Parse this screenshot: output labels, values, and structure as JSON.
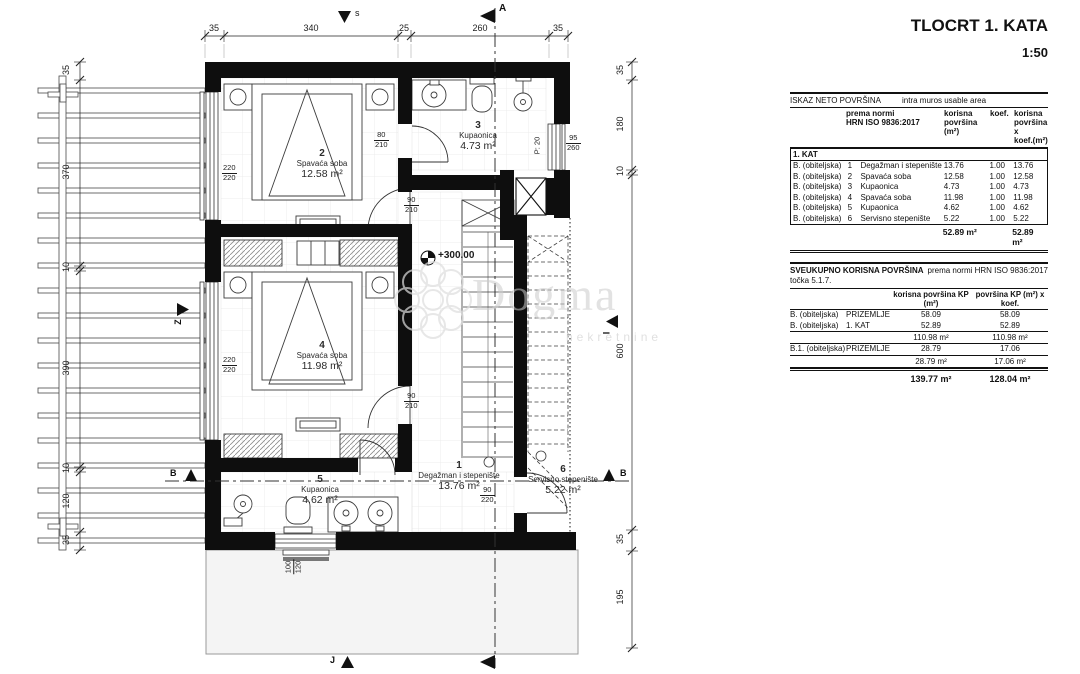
{
  "title": {
    "line1": "TLOCRT 1. KATA",
    "line2": "1:50"
  },
  "watermark": {
    "name": "Dogma",
    "subtitle": "nekretnine"
  },
  "compass": {
    "north": "s",
    "west": "Z",
    "east": "I",
    "south": "J"
  },
  "sections": {
    "a_top": "A",
    "b_left": "B",
    "b_right": "B"
  },
  "level": "+300.00",
  "rooms": {
    "r1": {
      "num": "1",
      "name": "Degažman i stepenište",
      "area": "13.76 m²"
    },
    "r2": {
      "num": "2",
      "name": "Spavaća soba",
      "area": "12.58 m²"
    },
    "r3": {
      "num": "3",
      "name": "Kupaonica",
      "area": "4.73 m²"
    },
    "r4": {
      "num": "4",
      "name": "Spavaća soba",
      "area": "11.98 m²"
    },
    "r5": {
      "num": "5",
      "name": "Kupaonica",
      "area": "4.62 m²"
    },
    "r6": {
      "num": "6",
      "name": "Servisno stepenište",
      "area": "5.22 m²"
    }
  },
  "openings": {
    "bath3_door": {
      "w": "80",
      "h": "210"
    },
    "bed2_door": {
      "w": "90",
      "h": "210"
    },
    "bed4_door": {
      "w": "90",
      "h": "210"
    },
    "service_door": {
      "w": "90",
      "h": "220"
    },
    "bed2_window": {
      "w": "220",
      "h": "220"
    },
    "bed4_window": {
      "w": "220",
      "h": "220"
    },
    "bath3_window": {
      "w": "95",
      "h": "260",
      "parapet": "P: 20"
    },
    "bath5_window": {
      "w": "100",
      "h": "120"
    }
  },
  "dims": {
    "top": [
      "35",
      "340",
      "25",
      "260",
      "35"
    ],
    "left": [
      "35",
      "370",
      "10",
      "390",
      "10",
      "120",
      "35"
    ],
    "right": [
      "35",
      "180",
      "10",
      "600",
      "35",
      "195"
    ]
  },
  "net_table": {
    "title": "ISKAZ NETO POVRŠINA",
    "subtitle": "intra muros usable area",
    "col_norm1": "prema normi",
    "col_norm2": "HRN ISO 9836:2017",
    "col_area1": "korisna",
    "col_area2": "površina (m²)",
    "col_koef": "koef.",
    "col_tot1": "korisna",
    "col_tot2": "površina x",
    "col_tot3": "koef.(m²)",
    "section": "1. KAT",
    "rows": [
      {
        "type": "B. (obiteljska)",
        "num": "1",
        "name": "Degažman i stepenište",
        "area": "13.76",
        "koef": "1.00",
        "total": "13.76"
      },
      {
        "type": "B. (obiteljska)",
        "num": "2",
        "name": "Spavaća soba",
        "area": "12.58",
        "koef": "1.00",
        "total": "12.58"
      },
      {
        "type": "B. (obiteljska)",
        "num": "3",
        "name": "Kupaonica",
        "area": "4.73",
        "koef": "1.00",
        "total": "4.73"
      },
      {
        "type": "B. (obiteljska)",
        "num": "4",
        "name": "Spavaća soba",
        "area": "11.98",
        "koef": "1.00",
        "total": "11.98"
      },
      {
        "type": "B. (obiteljska)",
        "num": "5",
        "name": "Kupaonica",
        "area": "4.62",
        "koef": "1.00",
        "total": "4.62"
      },
      {
        "type": "B. (obiteljska)",
        "num": "6",
        "name": "Servisno stepenište",
        "area": "5.22",
        "koef": "1.00",
        "total": "5.22"
      }
    ],
    "total_area": "52.89 m²",
    "total_koef": "52.89 m²"
  },
  "summary_table": {
    "title_bold": "SVEUKUPNO KORISNA POVRŠINA",
    "title_rest": "prema normi HRN ISO 9836:2017 točka 5.1.7.",
    "col_a": "korisna površina KP (m²)",
    "col_b": "površina KP (m²) x koef.",
    "rows": [
      {
        "type": "B. (obiteljska)",
        "floor": "PRIZEMLJE",
        "a": "58.09",
        "b": "58.09"
      },
      {
        "type": "B. (obiteljska)",
        "floor": "1. KAT",
        "a": "52.89",
        "b": "52.89"
      }
    ],
    "sub1_a": "110.98 m²",
    "sub1_b": "110.98 m²",
    "row_b1": {
      "type": "B.1. (obiteljska)",
      "floor": "PRIZEMLJE",
      "a": "28.79",
      "b": "17.06"
    },
    "sub2_a": "28.79 m²",
    "sub2_b": "17.06 m²",
    "total_a": "139.77 m²",
    "total_b": "128.04 m²"
  }
}
